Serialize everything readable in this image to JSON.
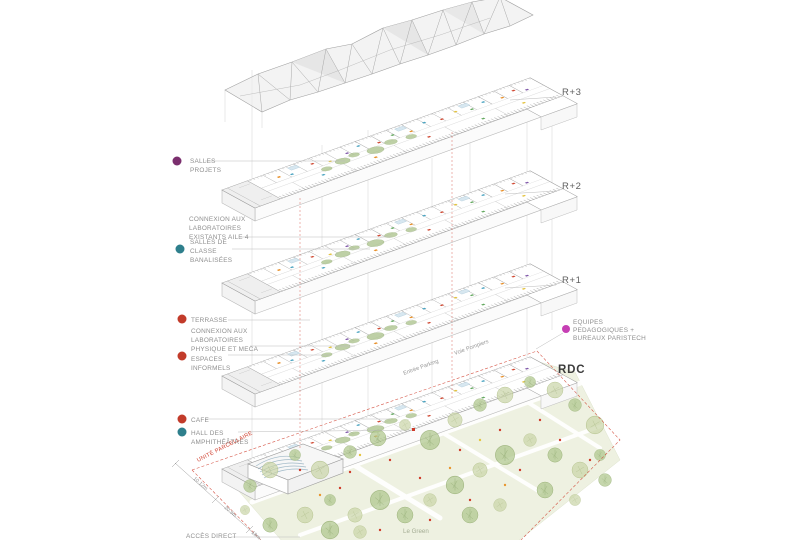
{
  "diagram": {
    "type": "exploded-axonometric-building-program",
    "levels": [
      {
        "label": "R+3"
      },
      {
        "label": "R+2"
      },
      {
        "label": "R+1"
      },
      {
        "label": "RDC"
      }
    ],
    "left_annotations": [
      {
        "dot_color": "#7b2f6e",
        "lines": [
          "SALLES",
          "PROJETS"
        ]
      },
      {
        "dot_color": "",
        "lines": [
          "CONNEXION AUX",
          "LABORATOIRES",
          "EXISTANTS AILE 4"
        ]
      },
      {
        "dot_color": "#2e7f8c",
        "lines": [
          "SALLES DE",
          "CLASSE",
          "BANALISÉES"
        ]
      },
      {
        "dot_color": "#c23b2a",
        "lines": [
          "TERRASSE"
        ]
      },
      {
        "dot_color": "",
        "lines": [
          "CONNEXION AUX",
          "LABORATOIRES",
          "PHYSIQUE ET MECA"
        ]
      },
      {
        "dot_color": "#c23b2a",
        "lines": [
          "ESPACES",
          "INFORMELS"
        ]
      },
      {
        "dot_color": "#c23b2a",
        "lines": [
          "CAFE"
        ]
      },
      {
        "dot_color": "#2e7f8c",
        "lines": [
          "HALL DES",
          "AMPHITHÉÂTRES"
        ]
      }
    ],
    "right_annotation": {
      "dot_color": "#c63fb4",
      "lines": [
        "EQUIPES",
        "PEDAGOGIQUES +",
        "BUREAUX PARISTECH"
      ]
    },
    "site_labels": {
      "unite_parcellaire": "UNITÉ PARCELLAIRE",
      "entree_parking": "Entrée Parking",
      "voie_pompiers": "Voie Pompiers",
      "acces_direct": "ACCÈS DIRECT",
      "le_green": "Le Green"
    },
    "dimensions": [
      "10.12m",
      "20.9m",
      "18m"
    ],
    "colors": {
      "line_gray": "#9a9a9a",
      "projection_gray": "#cfcfcf",
      "boundary_red": "#cf3b2a",
      "tree_green": "#aec68c",
      "park_green": "#eef1e1",
      "canopy_gray": "#ececec"
    }
  }
}
